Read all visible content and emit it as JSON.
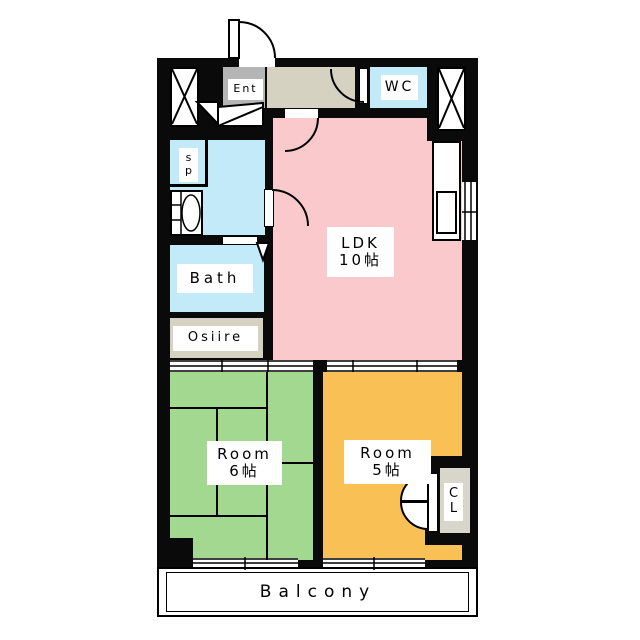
{
  "colors": {
    "wall": "#0a0a0a",
    "ldk": "#f9c9cb",
    "room6": "#a2d88f",
    "room5": "#f9c155",
    "water": "#c2eaf8",
    "hall": "#d5d2c2",
    "ent": "#b5b5b5",
    "cl": "#d8d5cb"
  },
  "rooms": {
    "ent": {
      "label": "Ent"
    },
    "wc": {
      "label": "WC"
    },
    "sp": {
      "line1": "s",
      "line2": "p"
    },
    "bath": {
      "label": "Bath"
    },
    "osiire": {
      "label": "Osiire"
    },
    "ldk": {
      "label": "LDK",
      "size": "10帖"
    },
    "room6": {
      "label": "Room",
      "size": "6帖"
    },
    "room5": {
      "label": "Room",
      "size": "5帖"
    },
    "cl": {
      "line1": "C",
      "line2": "L"
    },
    "balcony": {
      "label": "Balcony"
    }
  }
}
